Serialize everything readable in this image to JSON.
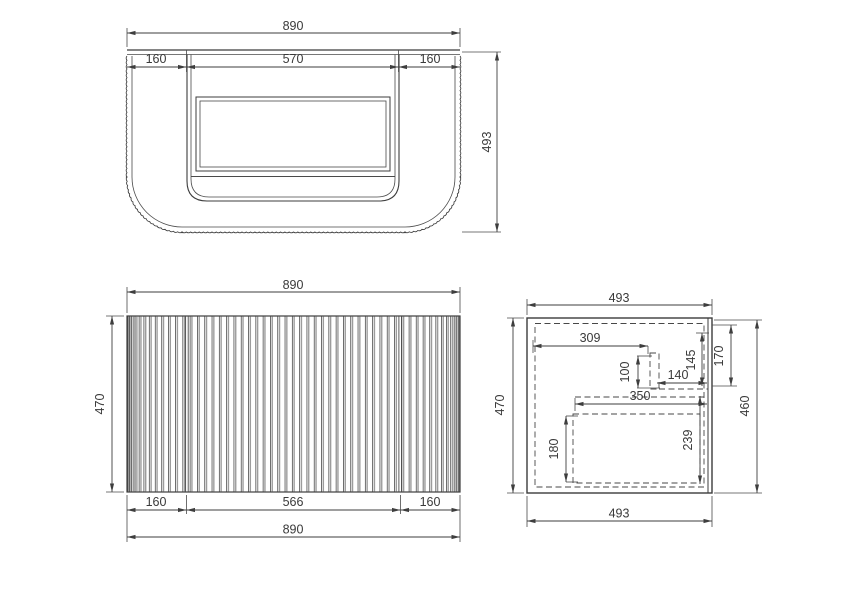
{
  "drawing": {
    "title": "vanity-cabinet-technical-drawing",
    "colors": {
      "line": "#3d3d3d",
      "flute_shading": "#9c9c9c",
      "background": "#ffffff"
    },
    "views": {
      "top": {
        "dims": {
          "overall_width": "890",
          "left_offset": "160",
          "opening_width": "570",
          "right_offset": "160",
          "depth": "493"
        }
      },
      "front": {
        "dims": {
          "overall_width": "890",
          "height": "470",
          "left_panel": "160",
          "center_panel": "566",
          "right_panel": "160",
          "overall_width_bottom": "890"
        }
      },
      "side": {
        "dims": {
          "depth_top": "493",
          "height_left": "470",
          "internal_depth": "309",
          "bracket_height": "100",
          "bracket_offset": "140",
          "rail_drop": "145",
          "top_clearance": "170",
          "drawer_depth": "350",
          "drawer_height": "180",
          "cavity_height": "239",
          "height_right": "460",
          "depth_bottom": "493"
        }
      }
    }
  }
}
